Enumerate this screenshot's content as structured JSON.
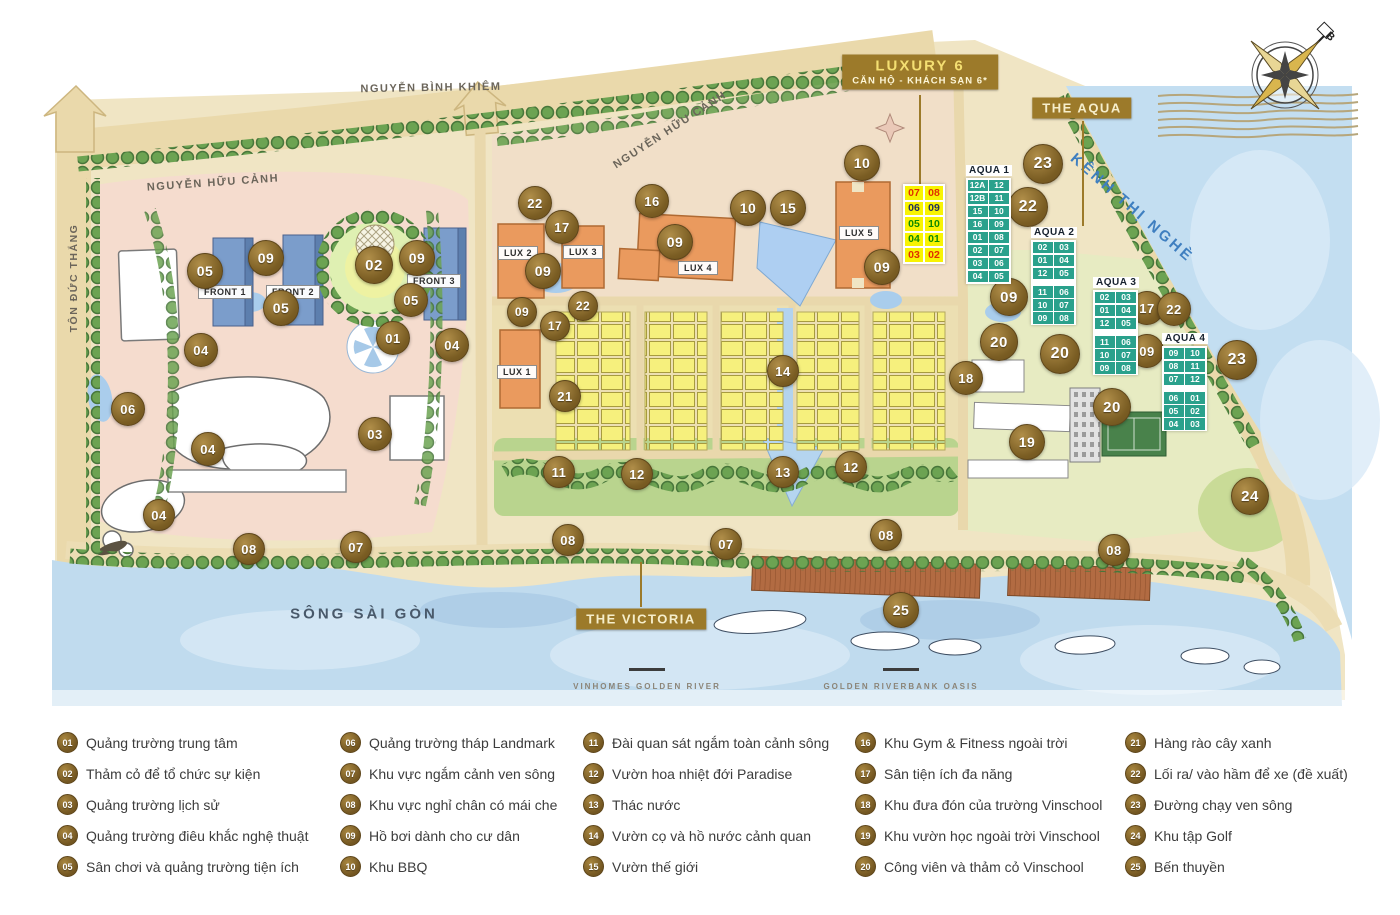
{
  "map": {
    "compass_label": "B",
    "streets": [
      {
        "id": "nguyen-binh-khiem",
        "label": "NGUYỄN BÌNH KHIÊM",
        "x": 431,
        "y": 88,
        "rotate": -1,
        "size": 11,
        "spacing": 1.5,
        "color": "#6b655a"
      },
      {
        "id": "nguyen-huu-canh-west",
        "label": "NGUYỄN HỮU CẢNH",
        "x": 213,
        "y": 183,
        "rotate": -4,
        "size": 11,
        "spacing": 1.5,
        "color": "#6b655a"
      },
      {
        "id": "nguyen-huu-canh-mid",
        "label": "NGUYỄN HỮU CẢNH",
        "x": 670,
        "y": 130,
        "rotate": -33,
        "size": 11,
        "spacing": 1.5,
        "color": "#6b655a"
      },
      {
        "id": "ton-duc-thang",
        "label": "TÔN ĐỨC THẮNG",
        "x": 74,
        "y": 278,
        "rotate": -90,
        "size": 10.5,
        "spacing": 1.5,
        "color": "#6b655a"
      },
      {
        "id": "kenh-thi-nghe",
        "label": "KÊNH THỊ NGHÈ",
        "x": 1132,
        "y": 208,
        "rotate": 41,
        "size": 15,
        "spacing": 3,
        "color": "#3f7fc0"
      },
      {
        "id": "song-sai-gon",
        "label": "SÔNG SÀI GÒN",
        "x": 364,
        "y": 614,
        "rotate": 0,
        "size": 15,
        "spacing": 3,
        "color": "#49596a"
      }
    ],
    "badges": [
      {
        "id": "luxury-6",
        "lines": [
          "LUXURY 6",
          "CĂN HỘ - KHÁCH SẠN 6*"
        ],
        "x": 920,
        "y": 72
      },
      {
        "id": "the-aqua",
        "lines": [
          "THE AQUA"
        ],
        "x": 1082,
        "y": 108
      },
      {
        "id": "the-victoria",
        "lines": [
          "THE VICTORIA"
        ],
        "x": 641,
        "y": 619
      }
    ],
    "leader_lines": [
      {
        "x": 920,
        "y1": 95,
        "y2": 186
      },
      {
        "x": 1083,
        "y1": 121,
        "y2": 226
      },
      {
        "x": 641,
        "y1": 562,
        "y2": 607
      }
    ],
    "building_labels": [
      {
        "label": "FRONT 1",
        "x": 225,
        "y": 292
      },
      {
        "label": "FRONT 2",
        "x": 293,
        "y": 292
      },
      {
        "label": "FRONT 3",
        "x": 434,
        "y": 281
      },
      {
        "label": "LUX 1",
        "x": 517,
        "y": 372
      },
      {
        "label": "LUX 2",
        "x": 518,
        "y": 253
      },
      {
        "label": "LUX 3",
        "x": 583,
        "y": 252
      },
      {
        "label": "LUX 4",
        "x": 698,
        "y": 268
      },
      {
        "label": "LUX 5",
        "x": 859,
        "y": 233
      }
    ],
    "markers": [
      {
        "n": "05",
        "x": 205,
        "y": 271,
        "s": 34
      },
      {
        "n": "09",
        "x": 266,
        "y": 258,
        "s": 34
      },
      {
        "n": "05",
        "x": 281,
        "y": 308,
        "s": 34
      },
      {
        "n": "02",
        "x": 374,
        "y": 265,
        "s": 36
      },
      {
        "n": "09",
        "x": 417,
        "y": 258,
        "s": 34
      },
      {
        "n": "05",
        "x": 411,
        "y": 300,
        "s": 32
      },
      {
        "n": "01",
        "x": 393,
        "y": 338,
        "s": 32
      },
      {
        "n": "04",
        "x": 201,
        "y": 350,
        "s": 32
      },
      {
        "n": "04",
        "x": 452,
        "y": 345,
        "s": 32
      },
      {
        "n": "06",
        "x": 128,
        "y": 409,
        "s": 32
      },
      {
        "n": "04",
        "x": 208,
        "y": 449,
        "s": 32
      },
      {
        "n": "03",
        "x": 375,
        "y": 434,
        "s": 32
      },
      {
        "n": "04",
        "x": 159,
        "y": 515,
        "s": 30
      },
      {
        "n": "08",
        "x": 249,
        "y": 549,
        "s": 30
      },
      {
        "n": "07",
        "x": 356,
        "y": 547,
        "s": 30
      },
      {
        "n": "22",
        "x": 535,
        "y": 203,
        "s": 32
      },
      {
        "n": "17",
        "x": 562,
        "y": 227,
        "s": 32
      },
      {
        "n": "09",
        "x": 543,
        "y": 271,
        "s": 34
      },
      {
        "n": "16",
        "x": 652,
        "y": 201,
        "s": 32
      },
      {
        "n": "09",
        "x": 675,
        "y": 242,
        "s": 34
      },
      {
        "n": "10",
        "x": 748,
        "y": 208,
        "s": 34
      },
      {
        "n": "15",
        "x": 788,
        "y": 208,
        "s": 34
      },
      {
        "n": "09",
        "x": 522,
        "y": 312,
        "s": 28
      },
      {
        "n": "17",
        "x": 555,
        "y": 326,
        "s": 28
      },
      {
        "n": "22",
        "x": 583,
        "y": 306,
        "s": 28
      },
      {
        "n": "21",
        "x": 565,
        "y": 396,
        "s": 30
      },
      {
        "n": "11",
        "x": 559,
        "y": 472,
        "s": 30
      },
      {
        "n": "12",
        "x": 637,
        "y": 474,
        "s": 30
      },
      {
        "n": "14",
        "x": 783,
        "y": 371,
        "s": 30
      },
      {
        "n": "13",
        "x": 783,
        "y": 472,
        "s": 30
      },
      {
        "n": "12",
        "x": 851,
        "y": 467,
        "s": 30
      },
      {
        "n": "10",
        "x": 862,
        "y": 163,
        "s": 34
      },
      {
        "n": "09",
        "x": 882,
        "y": 267,
        "s": 34
      },
      {
        "n": "23",
        "x": 1043,
        "y": 164,
        "s": 38
      },
      {
        "n": "22",
        "x": 1028,
        "y": 207,
        "s": 38
      },
      {
        "n": "09",
        "x": 1009,
        "y": 297,
        "s": 36
      },
      {
        "n": "20",
        "x": 999,
        "y": 342,
        "s": 36
      },
      {
        "n": "20",
        "x": 1060,
        "y": 354,
        "s": 38
      },
      {
        "n": "18",
        "x": 966,
        "y": 378,
        "s": 32
      },
      {
        "n": "20",
        "x": 1112,
        "y": 407,
        "s": 36
      },
      {
        "n": "19",
        "x": 1027,
        "y": 442,
        "s": 34
      },
      {
        "n": "17",
        "x": 1147,
        "y": 308,
        "s": 32
      },
      {
        "n": "22",
        "x": 1174,
        "y": 309,
        "s": 32
      },
      {
        "n": "09",
        "x": 1147,
        "y": 351,
        "s": 32
      },
      {
        "n": "23",
        "x": 1237,
        "y": 360,
        "s": 38
      },
      {
        "n": "24",
        "x": 1250,
        "y": 496,
        "s": 36
      },
      {
        "n": "08",
        "x": 568,
        "y": 540,
        "s": 30
      },
      {
        "n": "07",
        "x": 726,
        "y": 544,
        "s": 30
      },
      {
        "n": "08",
        "x": 886,
        "y": 535,
        "s": 30
      },
      {
        "n": "08",
        "x": 1114,
        "y": 550,
        "s": 30
      },
      {
        "n": "25",
        "x": 901,
        "y": 610,
        "s": 34
      }
    ],
    "unit_table": {
      "x": 903,
      "y": 184,
      "rows": [
        {
          "cells": [
            "07",
            "08"
          ],
          "color": "#e03000"
        },
        {
          "cells": [
            "06",
            "09"
          ],
          "color": "#23325a"
        },
        {
          "cells": [
            "05",
            "10"
          ],
          "color": "#0f8a00"
        },
        {
          "cells": [
            "04",
            "01"
          ],
          "color": "#0f8a00"
        },
        {
          "cells": [
            "03",
            "02"
          ],
          "color": "#e03000"
        }
      ]
    },
    "aqua_tables": [
      {
        "name": "AQUA 1",
        "x": 966,
        "y": 160,
        "gap_after": -1,
        "rows": [
          [
            "12A",
            "12"
          ],
          [
            "12B",
            "11"
          ],
          [
            "15",
            "10"
          ],
          [
            "16",
            "09"
          ],
          [
            "01",
            "08"
          ],
          [
            "02",
            "07"
          ],
          [
            "03",
            "06"
          ],
          [
            "04",
            "05"
          ]
        ]
      },
      {
        "name": "AQUA 2",
        "x": 1031,
        "y": 222,
        "gap_after": 2,
        "rows": [
          [
            "02",
            "03"
          ],
          [
            "01",
            "04"
          ],
          [
            "12",
            "05"
          ],
          [
            "11",
            "06"
          ],
          [
            "10",
            "07"
          ],
          [
            "09",
            "08"
          ]
        ]
      },
      {
        "name": "AQUA 3",
        "x": 1093,
        "y": 272,
        "gap_after": 2,
        "rows": [
          [
            "02",
            "03"
          ],
          [
            "01",
            "04"
          ],
          [
            "12",
            "05"
          ],
          [
            "11",
            "06"
          ],
          [
            "10",
            "07"
          ],
          [
            "09",
            "08"
          ]
        ]
      },
      {
        "name": "AQUA 4",
        "x": 1162,
        "y": 328,
        "gap_after": 2,
        "rows": [
          [
            "09",
            "10"
          ],
          [
            "08",
            "11"
          ],
          [
            "07",
            "12"
          ],
          [
            "06",
            "01"
          ],
          [
            "05",
            "02"
          ],
          [
            "04",
            "03"
          ]
        ]
      }
    ],
    "captions": [
      {
        "label": "VINHOMES GOLDEN RIVER",
        "x": 647,
        "y": 682
      },
      {
        "label": "GOLDEN RIVERBANK OASIS",
        "x": 901,
        "y": 682
      }
    ],
    "caption_dash_y": 668
  },
  "legend": {
    "top": 727,
    "columns": [
      {
        "x": 57,
        "items": [
          {
            "num": "01",
            "label": "Quảng trường trung tâm"
          },
          {
            "num": "02",
            "label": "Thảm cỏ để tổ chức sự kiện"
          },
          {
            "num": "03",
            "label": "Quảng trường lịch sử"
          },
          {
            "num": "04",
            "label": "Quảng trường điêu khắc nghệ thuật"
          },
          {
            "num": "05",
            "label": "Sân chơi và quảng trường tiện ích"
          }
        ]
      },
      {
        "x": 340,
        "items": [
          {
            "num": "06",
            "label": "Quảng trường tháp Landmark"
          },
          {
            "num": "07",
            "label": "Khu vực ngắm cảnh ven sông"
          },
          {
            "num": "08",
            "label": "Khu vực nghỉ chân có mái che"
          },
          {
            "num": "09",
            "label": "Hồ bơi dành cho cư dân"
          },
          {
            "num": "10",
            "label": "Khu BBQ"
          }
        ]
      },
      {
        "x": 583,
        "items": [
          {
            "num": "11",
            "label": "Đài quan sát ngắm toàn cảnh sông"
          },
          {
            "num": "12",
            "label": "Vườn hoa nhiệt đới Paradise"
          },
          {
            "num": "13",
            "label": "Thác nước"
          },
          {
            "num": "14",
            "label": "Vườn cọ và hồ nước cảnh quan"
          },
          {
            "num": "15",
            "label": "Vườn thế giới"
          }
        ]
      },
      {
        "x": 855,
        "items": [
          {
            "num": "16",
            "label": "Khu Gym & Fitness ngoài trời"
          },
          {
            "num": "17",
            "label": "Sân tiện ích đa năng"
          },
          {
            "num": "18",
            "label": "Khu đưa đón của trường Vinschool"
          },
          {
            "num": "19",
            "label": "Khu vườn học ngoài trời Vinschool"
          },
          {
            "num": "20",
            "label": "Công viên và thảm cỏ Vinschool"
          }
        ]
      },
      {
        "x": 1125,
        "items": [
          {
            "num": "21",
            "label": "Hàng rào cây xanh"
          },
          {
            "num": "22",
            "label": "Lối ra/ vào hầm để xe (đề xuất)"
          },
          {
            "num": "23",
            "label": "Đường chạy ven sông"
          },
          {
            "num": "24",
            "label": "Khu tập Golf"
          },
          {
            "num": "25",
            "label": "Bến thuyền"
          }
        ]
      }
    ]
  }
}
